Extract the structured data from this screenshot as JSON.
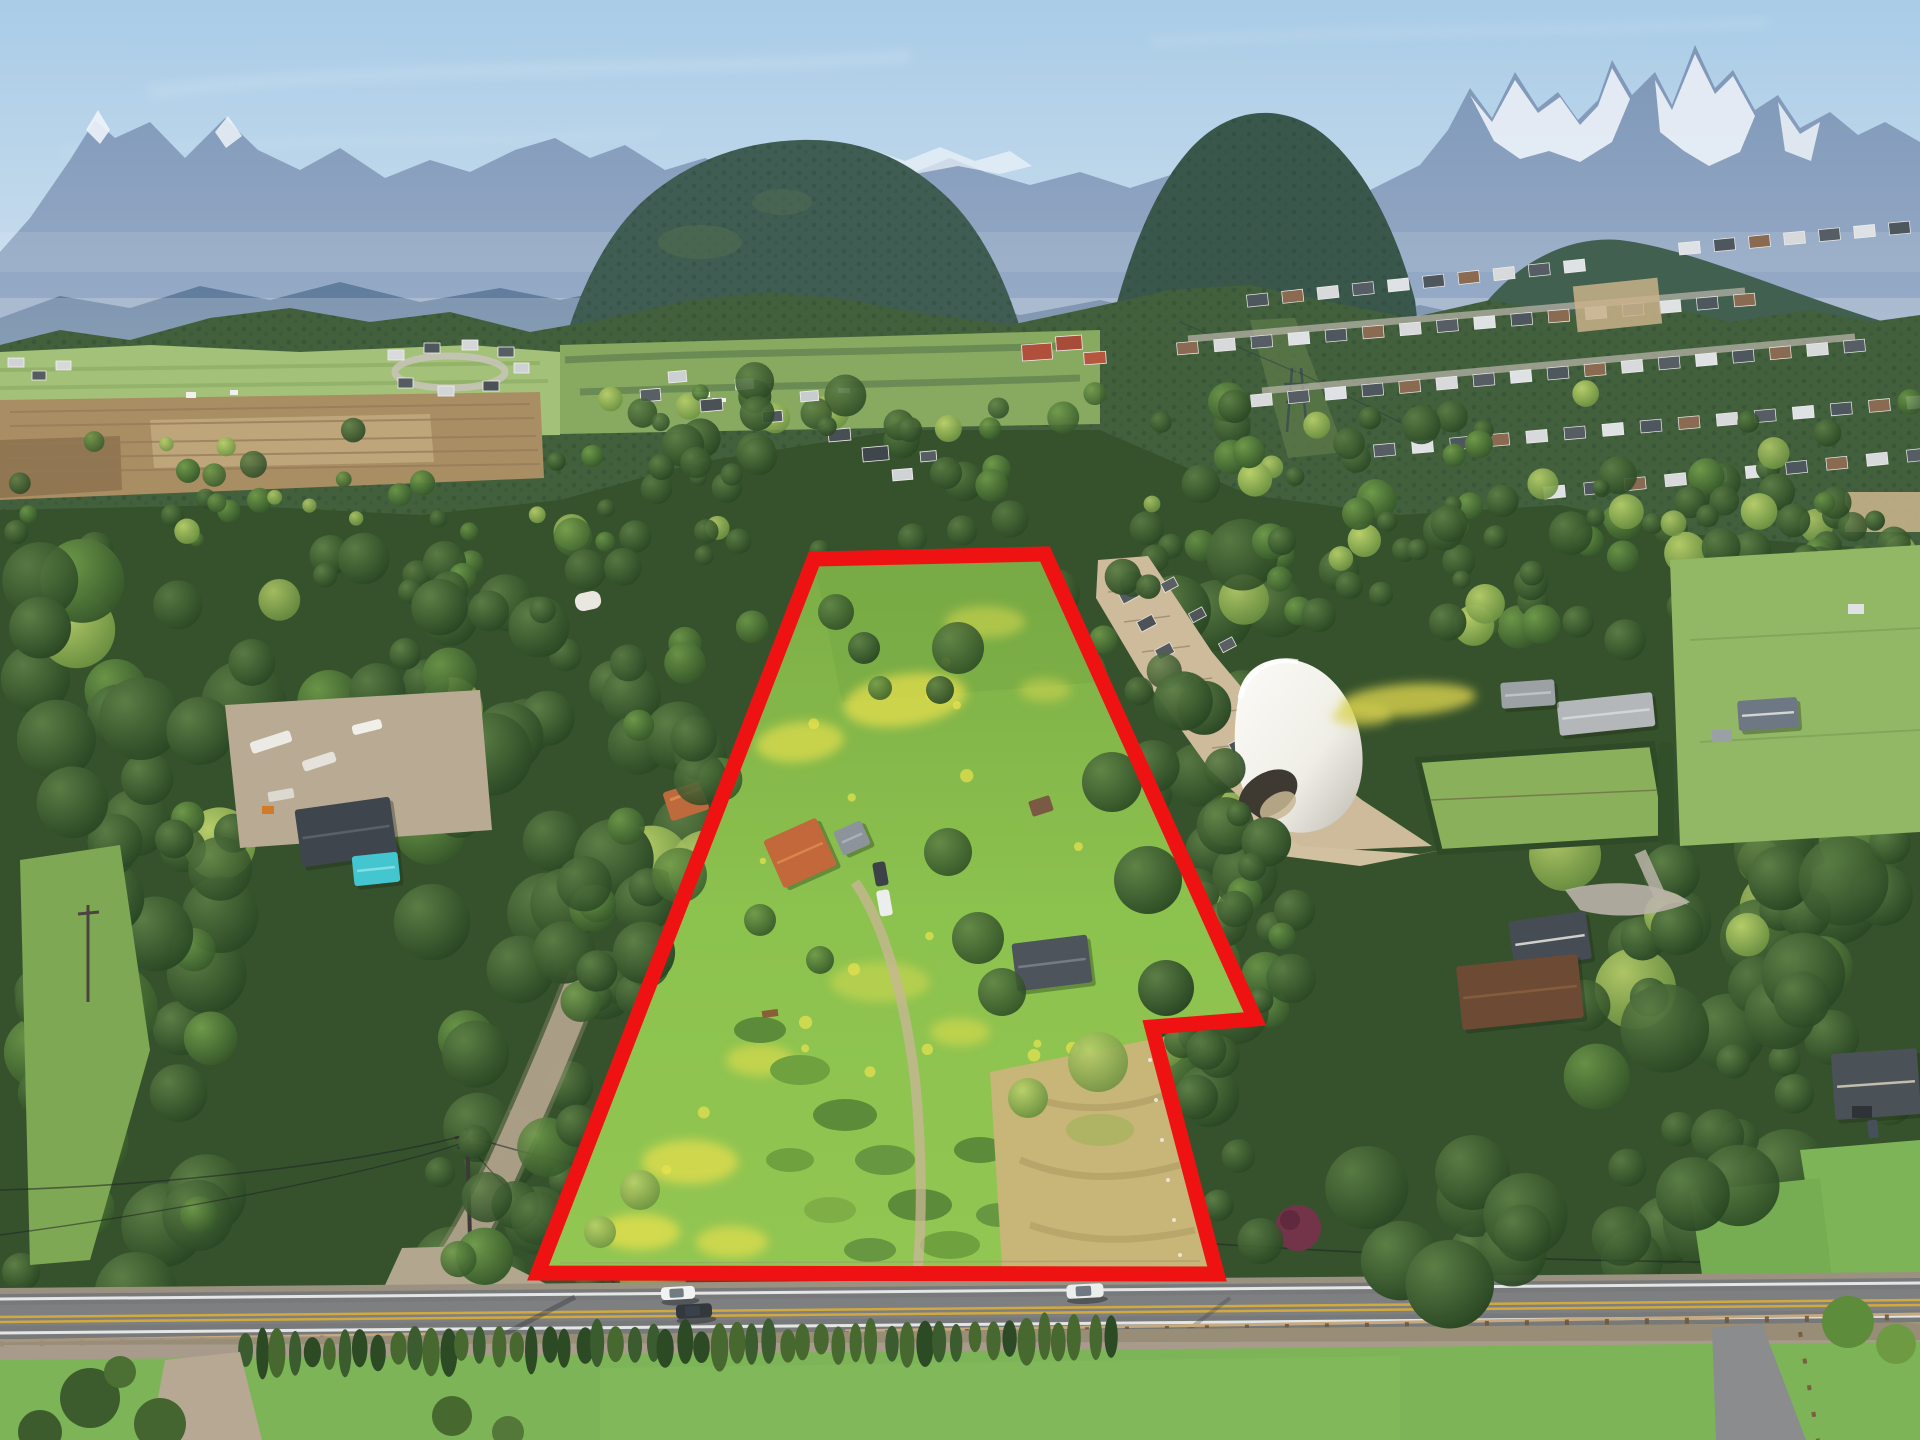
{
  "scene": {
    "type": "aerial-drone-real-estate-photo",
    "subject": "rural acreage property outlined in red, valley with mountain backdrop, equestrian facility, rural road in foreground"
  },
  "palette": {
    "sky_top": "#a9cce7",
    "sky_horizon": "#e6eef4",
    "far_mountain": "#8099ba",
    "snow": "#edf3f9",
    "mid_ridge": "#5e7b9c",
    "forest_mountain": "#3f5d52",
    "forest_dark": "#23401f",
    "forest_base": "#36522c",
    "field_green": "#a3c178",
    "field_brown": "#a98e63",
    "meadow_green": "#8cc24e",
    "buttercup_yellow": "#e4de4d",
    "dry_grass": "#c8b578",
    "sand_paddock": "#cdbb9b",
    "road_asphalt": "#77797b",
    "road_yellow": "#d2a93e",
    "road_white": "#f0f1f1",
    "outline_red": "#ef1212",
    "pool_teal": "#43c6d0",
    "barn_roof_orange": "#c2683a",
    "dome_white": "#f6f5f0"
  },
  "property_outline": {
    "name": "highlighted-property-boundary",
    "stroke_width": 15,
    "points": [
      [
        814,
        559
      ],
      [
        1045,
        554
      ],
      [
        1255,
        1019
      ],
      [
        1152,
        1027
      ],
      [
        1217,
        1274
      ],
      [
        538,
        1273
      ]
    ]
  },
  "buildings": [
    {
      "name": "orange-roof-barn",
      "x": 800,
      "y": 853,
      "w": 58,
      "h": 52,
      "angle": -24,
      "color": "#c2683a",
      "ridge": "#dd8c50"
    },
    {
      "name": "barn-gray-annex",
      "x": 852,
      "y": 838,
      "w": 30,
      "h": 26,
      "angle": -24,
      "color": "#8d939a",
      "ridge": "#b0b6bc"
    },
    {
      "name": "main-residence",
      "x": 1052,
      "y": 963,
      "w": 76,
      "h": 48,
      "angle": -7,
      "color": "#4e545b",
      "ridge": "#7c838c"
    },
    {
      "name": "neighbor-house-with-pool",
      "x": 346,
      "y": 832,
      "w": 96,
      "h": 58,
      "angle": -8,
      "color": "#3e454d",
      "ridge": "#5d656e"
    },
    {
      "name": "swimming-pool",
      "x": 376,
      "y": 869,
      "w": 46,
      "h": 30,
      "angle": -6,
      "color": "#43c6d0",
      "ridge": "#8fe2e8"
    },
    {
      "name": "stable-long-building",
      "x": 1606,
      "y": 714,
      "w": 96,
      "h": 34,
      "angle": -6,
      "color": "#b3b7b9",
      "ridge": "#d8dbdc"
    },
    {
      "name": "flat-roof-outbuilding",
      "x": 1528,
      "y": 694,
      "w": 54,
      "h": 26,
      "angle": -4,
      "color": "#9ba1a4",
      "ridge": "#c3c8ca"
    },
    {
      "name": "white-farmhouse",
      "x": 1768,
      "y": 714,
      "w": 60,
      "h": 30,
      "angle": -4,
      "color": "#6e7884",
      "ridge": "#e8e6e0"
    },
    {
      "name": "white-house-gray-roof",
      "x": 1550,
      "y": 940,
      "w": 78,
      "h": 48,
      "angle": -8,
      "color": "#454c54",
      "ridge": "#e9e7e2"
    },
    {
      "name": "log-home",
      "x": 1520,
      "y": 992,
      "w": 122,
      "h": 64,
      "angle": -6,
      "color": "#6d4a33",
      "ridge": "#8a613f"
    },
    {
      "name": "bottom-right-house",
      "x": 1876,
      "y": 1084,
      "w": 86,
      "h": 66,
      "angle": -4,
      "color": "#4a5157",
      "ridge": "#d9d0bd"
    }
  ],
  "vehicles": [
    {
      "name": "white-sedan-westbound",
      "color": "#f1f2f2",
      "x": 678,
      "y": 1293,
      "w": 34,
      "h": 13,
      "angle": -3
    },
    {
      "name": "dark-suv-eastbound",
      "color": "#33383d",
      "x": 694,
      "y": 1311,
      "w": 36,
      "h": 14,
      "angle": -3
    },
    {
      "name": "white-sedan-eastbound",
      "color": "#eceeee",
      "x": 1085,
      "y": 1291,
      "w": 37,
      "h": 14,
      "angle": -3
    }
  ],
  "landmarks": [
    "snow-capped-peaks",
    "hazy-blue-range",
    "forested-foothills",
    "valley-farm-fields",
    "hillside-subdivision",
    "equestrian-dome-arena",
    "horse-paddock-alley",
    "subject-property-meadow",
    "buttercup-drifts",
    "orange-roof-barn",
    "main-residence",
    "neighbor-house-with-pool",
    "gravel-side-road",
    "rural-road",
    "cypress-hedgerow",
    "roadside-guardrail"
  ]
}
